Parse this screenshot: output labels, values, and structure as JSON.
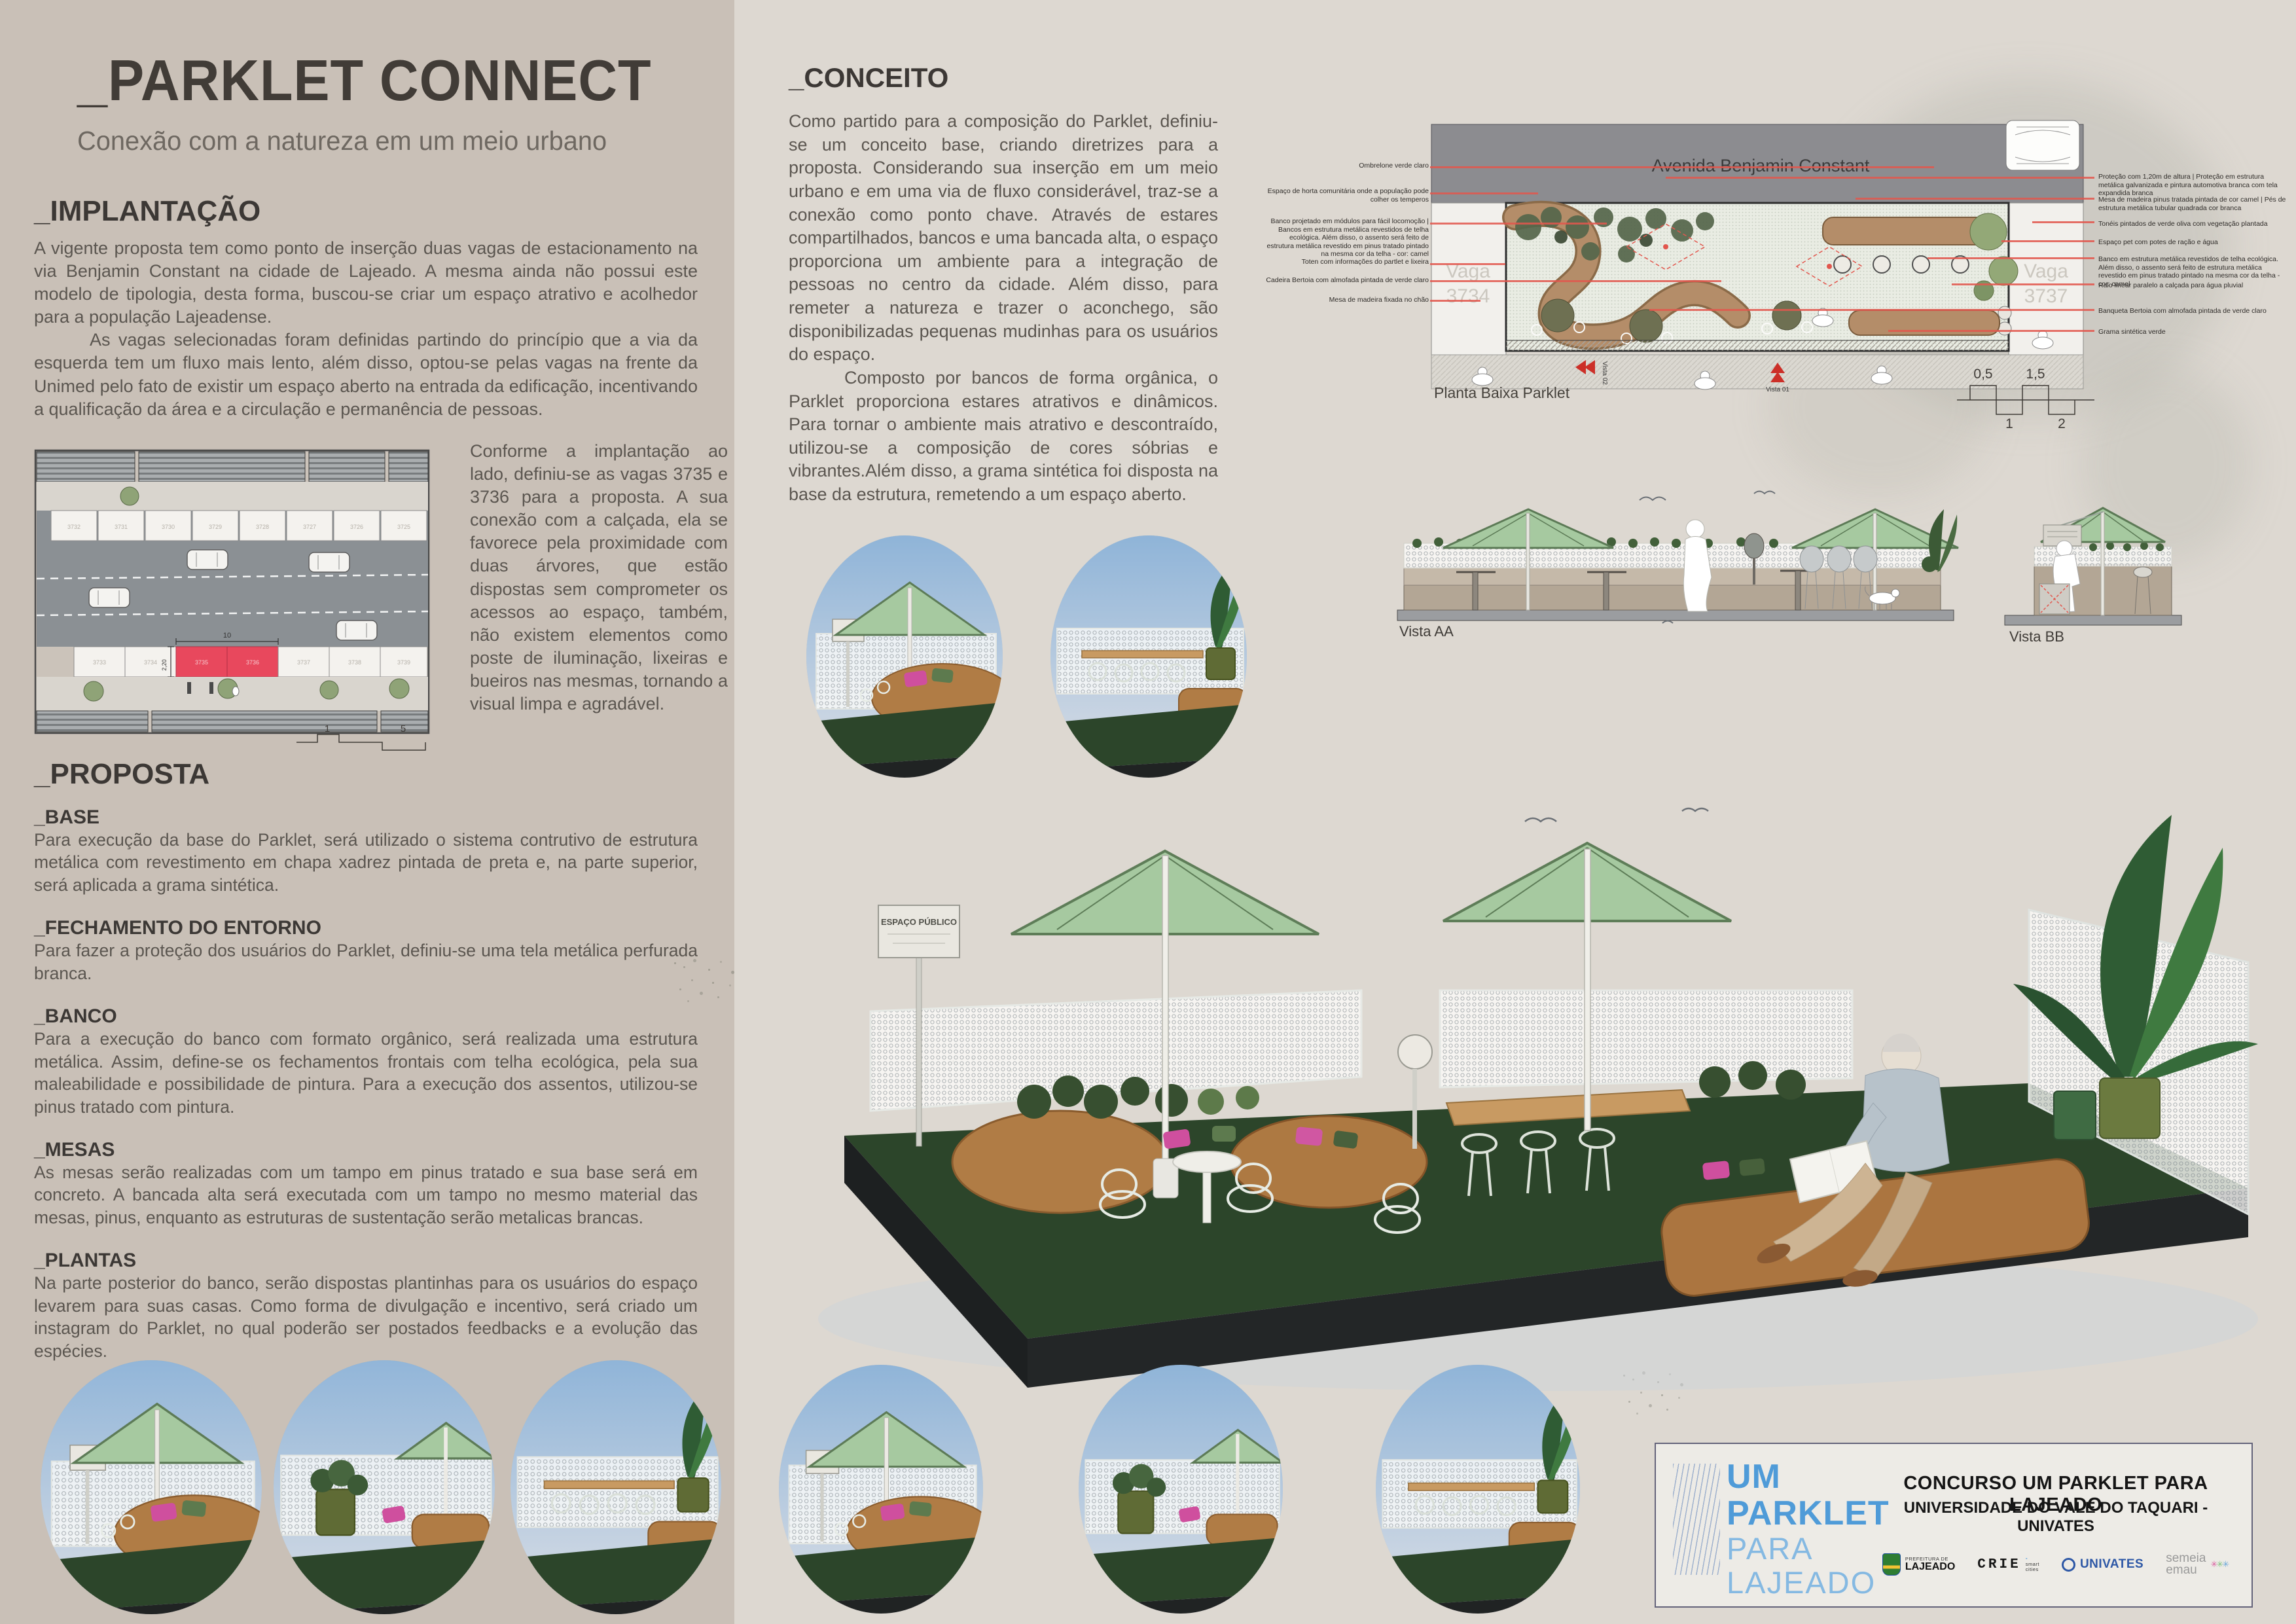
{
  "board": {
    "title": "_PARKLET CONNECT",
    "subtitle": "Conexão com a natureza em um meio urbano"
  },
  "implantacao": {
    "heading": "_IMPLANTAÇÃO",
    "p1": "A vigente proposta tem como ponto de inserção duas vagas de estacionamento na via Benjamin Constant na cidade de Lajeado. A mesma ainda não possui este modelo de tipologia, desta forma, buscou-se criar um espaço atrativo e acolhedor para a população Lajeadense.",
    "p2": "As vagas selecionadas foram definidas partindo do princípio que a via da esquerda tem um fluxo mais lento, além disso, optou-se pelas vagas na frente da Unimed pelo fato de existir um espaço aberto na entrada da edificação, incentivando a qualificação da área e a circulação e permanência de pessoas.",
    "side_note": "Conforme a implantação ao lado, definiu-se as vagas 3735 e 3736 para a proposta. A sua conexão com a calçada, ela se favorece pela proximidade com duas árvores, que estão dispostas sem comprometer os acessos ao espaço, também, não existem elementos como poste de iluminação, lixeiras e bueiros nas mesmas, tornando a visual limpa e agradável."
  },
  "site_plan": {
    "top_row_labels": [
      "3732",
      "3731",
      "3730",
      "3729",
      "3728",
      "3727",
      "3726",
      "3725"
    ],
    "bottom_row_labels": [
      "3733",
      "3734",
      "3735",
      "3736",
      "3737",
      "3738",
      "3739"
    ],
    "dim_width": "10",
    "dim_height": "2,20",
    "scale_labels": [
      "1",
      "5"
    ]
  },
  "proposta": {
    "heading": "_PROPOSTA",
    "sections": [
      {
        "heading": "_BASE",
        "body": "Para execução da base do Parklet, será utilizado o sistema contrutivo de estrutura metálica com revestimento em chapa xadrez pintada de preta e, na parte superior, será aplicada a grama sintética."
      },
      {
        "heading": "_FECHAMENTO DO ENTORNO",
        "body": "Para fazer a proteção dos usuários do Parklet, definiu-se uma tela metálica perfurada branca."
      },
      {
        "heading": "_BANCO",
        "body": "Para a execução do banco com formato orgânico, será realizada uma estrutura metálica. Assim, define-se os fechamentos frontais com telha ecológica, pela sua maleabilidade e possibilidade de pintura. Para a execução dos assentos, utilizou-se pinus tratado com pintura."
      },
      {
        "heading": "_MESAS",
        "body": "As mesas serão realizadas com um tampo em pinus tratado e sua base será em concreto. A bancada alta será executada com um tampo no mesmo material das mesas, pinus, enquanto as estruturas de sustentação serão metalicas brancas."
      },
      {
        "heading": "_PLANTAS",
        "body": "Na parte posterior do banco, serão dispostas plantinhas para os usuários do espaço levarem para suas casas. Como forma de divulgação e incentivo, será criado um instagram do Parklet, no qual poderão ser postados feedbacks e a evolução das espécies."
      }
    ]
  },
  "conceito": {
    "heading": "_CONCEITO",
    "p1": "Como partido para a composição do Parklet, definiu-se um conceito base, criando diretrizes para a proposta. Considerando sua inserção em um meio urbano e em uma via de fluxo considerável, traz-se a conexão como ponto chave. Através de estares compartilhados, bancos e uma bancada alta, o espaço proporciona um ambiente para a integração de pessoas no centro da cidade. Além disso, para remeter a natureza e trazer o aconchego, são disponibilizadas pequenas mudinhas para os usuários do espaço.",
    "p2": "Composto por bancos de forma orgânica, o Parklet proporciona estares atrativos e dinâmicos. Para tornar o ambiente mais atrativo e descontraído, utilizou-se a composição de cores sóbrias e vibrantes.Além disso, a grama sintética foi disposta na base da estrutura, remetendo a um espaço aberto."
  },
  "plan": {
    "street_label": "Avenida Benjamin Constant",
    "caption": "Planta Baixa Parklet",
    "vaga_left_word": "Vaga",
    "vaga_left_num": "3734",
    "vaga_right_word": "Vaga",
    "vaga_right_num": "3737",
    "vista_01": "Vista 01",
    "vista_02": "Vista 02",
    "scale_top": [
      "0,5",
      "1,5"
    ],
    "scale_bottom": [
      "1",
      "2"
    ],
    "left_annotations": [
      "Ombrelone verde claro",
      "Espaço de horta comunitária onde a população pode colher os temperos",
      "Banco projetado em módulos para fácil locomoção | Bancos em estrutura metálica revestidos de telha ecológica. Além disso, o assento será feito de estrutura metálica revestido em pinus tratado pintado na mesma cor da telha - cor: camel",
      "Toten com informações do partlet e lixeira",
      "Cadeira Bertoia com almofada pintada de verde claro",
      "Mesa de madeira fixada no chão"
    ],
    "right_annotations": [
      "Proteção com 1,20m de altura | Proteção em estrutura metálica galvanizada e pintura automotiva branca com tela expandida branca",
      "Mesa de madeira pinus tratada pintada de cor camel | Pés de estrutura metálica tubular quadrada cor branca",
      "Tonéis pintados de verde oliva com vegetação plantada",
      "Espaço pet com potes de ração e água",
      "Banco em estrutura metálica revestidos de telha ecológica. Além disso, o assento será feito de estrutura metálica revestido em pinus tratado pintado na mesma cor da telha - cor: camel",
      "Ralo linear paralelo a calçada para água pluvial",
      "Banqueta Bertoia com almofada pintada de verde claro",
      "Grama sintética verde"
    ]
  },
  "vistas": {
    "aa_label": "Vista AA",
    "bb_label": "Vista BB"
  },
  "render": {
    "sign_text": "ESPAÇO PÚBLICO"
  },
  "footer": {
    "logo_lines": [
      "UM",
      "PARKLET",
      "PARA",
      "LAJEADO"
    ],
    "contest_title": "CONCURSO UM PARKLET PARA LAJEADO",
    "contest_subtitle": "UNIVERSIDADE DO VALE DO TAQUARI - UNIVATES",
    "lajeado_small": "PREFEITURA DE",
    "lajeado_big": "LAJEADO",
    "crie": "CRIE",
    "crie_sub1": "smart",
    "crie_sub2": "cities",
    "univates": "UNIVATES",
    "semeia_1": "semeia",
    "semeia_2": "emau"
  },
  "colors": {
    "accent_red": "#e2574e",
    "umbrella_green": "#a6c9a0",
    "caramel": "#b0824f",
    "logo_blue": "#4f9bd8",
    "logo_blue_light": "#85b9e2",
    "grass_green": "#2c452a",
    "left_panel": "#c9c0b7",
    "right_panel": "#ddd8d1"
  }
}
